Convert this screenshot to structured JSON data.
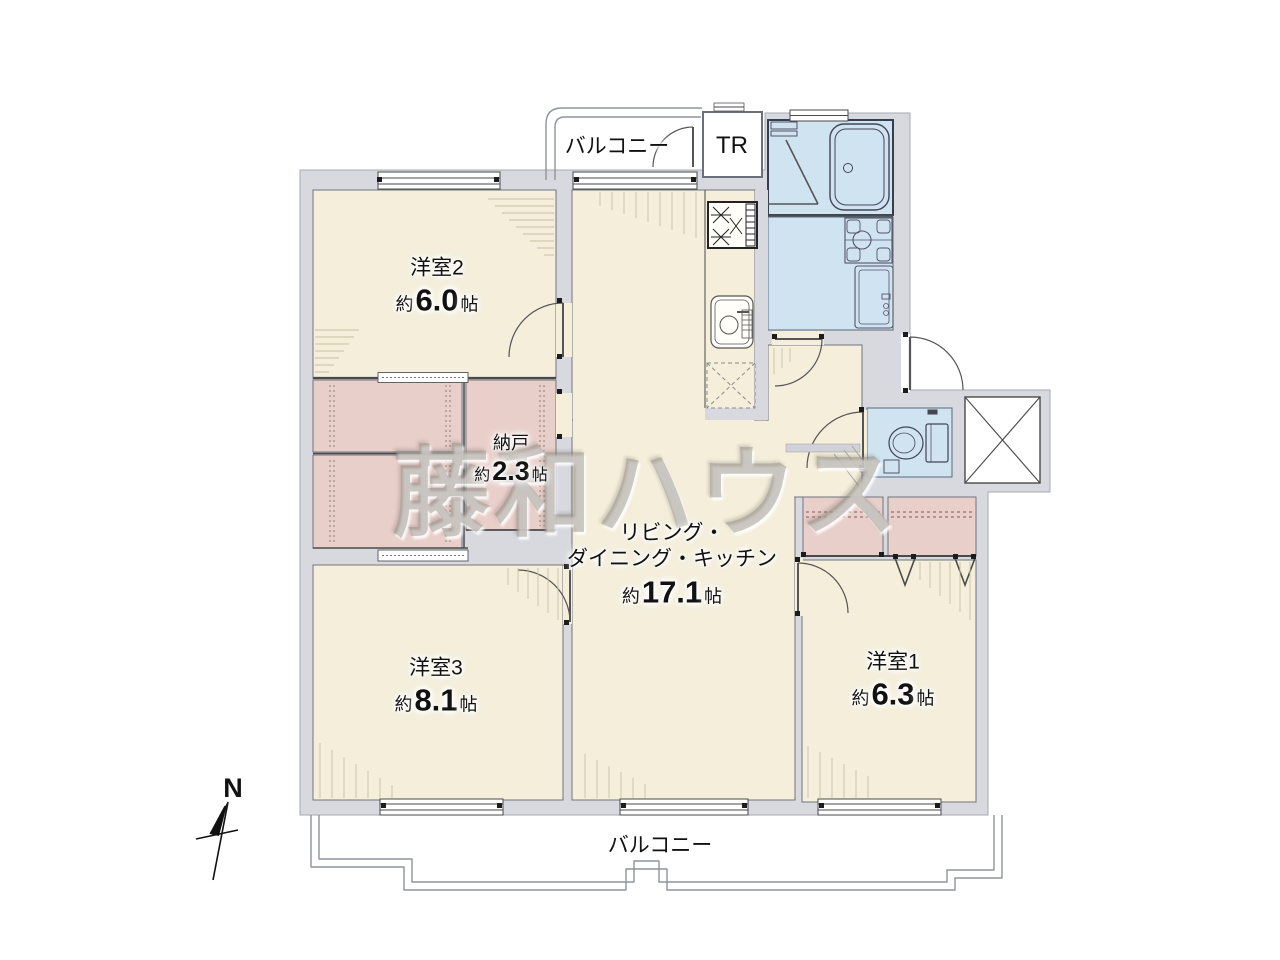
{
  "floorplan": {
    "watermark_text": "藤和ハウス",
    "compass_label": "N",
    "balcony_top_label": "バルコニー",
    "balcony_bottom_label": "バルコニー",
    "trunk_room_label": "TR",
    "rooms": {
      "western2": {
        "name": "洋室2",
        "approx": "約",
        "value": "6.0",
        "unit": "帖"
      },
      "storage": {
        "name": "納戸",
        "approx": "約",
        "value": "2.3",
        "unit": "帖"
      },
      "ldk": {
        "name1": "リビング・",
        "name2": "ダイニング・キッチン",
        "approx": "約",
        "value": "17.1",
        "unit": "帖"
      },
      "western3": {
        "name": "洋室3",
        "approx": "約",
        "value": "8.1",
        "unit": "帖"
      },
      "western1": {
        "name": "洋室1",
        "approx": "約",
        "value": "6.3",
        "unit": "帖"
      }
    },
    "colors": {
      "floor": "#f4eeda",
      "closet": "#e9cfca",
      "wet_area": "#cfe3f1",
      "wall": "#d7d9de",
      "outline": "#4a4a4a"
    }
  }
}
